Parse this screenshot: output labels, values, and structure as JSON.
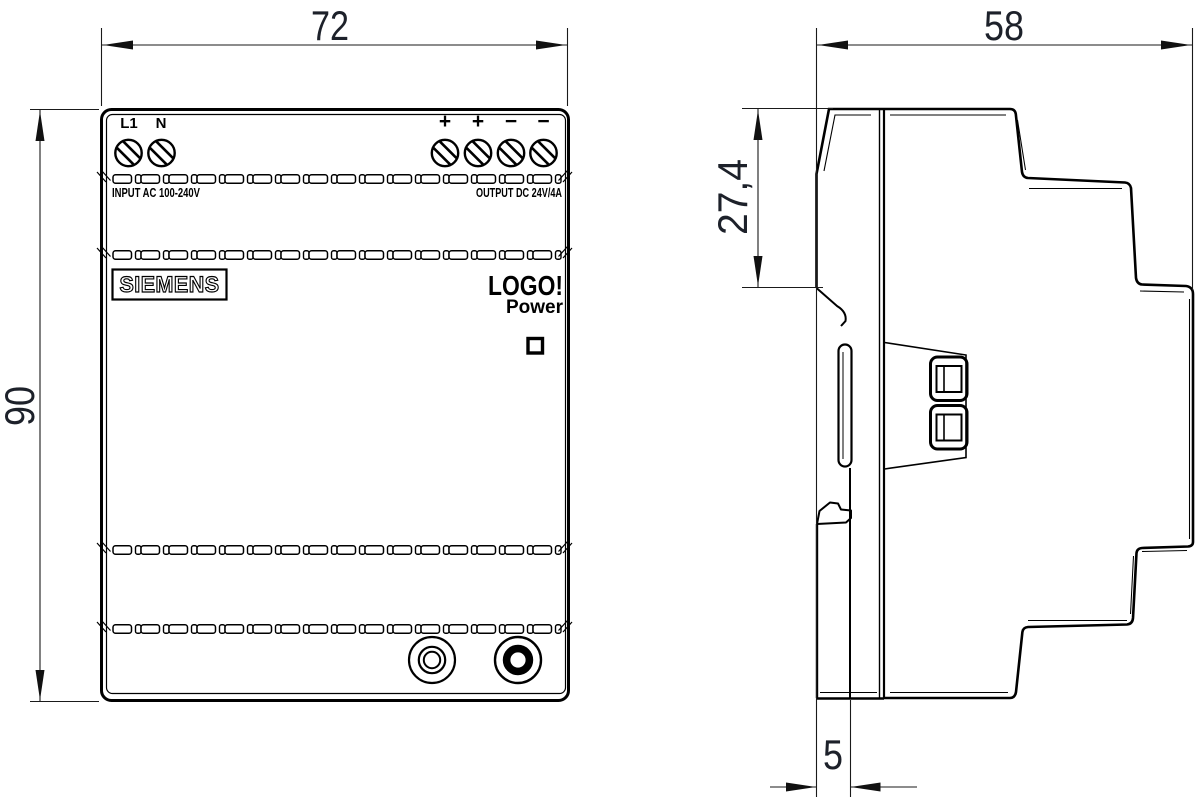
{
  "dimensions": {
    "front_width": "72",
    "front_height": "90",
    "side_depth": "58",
    "side_upper_depth": "27,4",
    "side_foot_depth": "5"
  },
  "front_view": {
    "terminals_left": [
      "L1",
      "N"
    ],
    "terminals_right": [
      "+",
      "+",
      "−",
      "−"
    ],
    "input_label": "INPUT AC 100-240V",
    "output_label": "OUTPUT DC 24V/4A",
    "brand": "SIEMENS",
    "product": "LOGO!",
    "product_sub": "Power"
  }
}
